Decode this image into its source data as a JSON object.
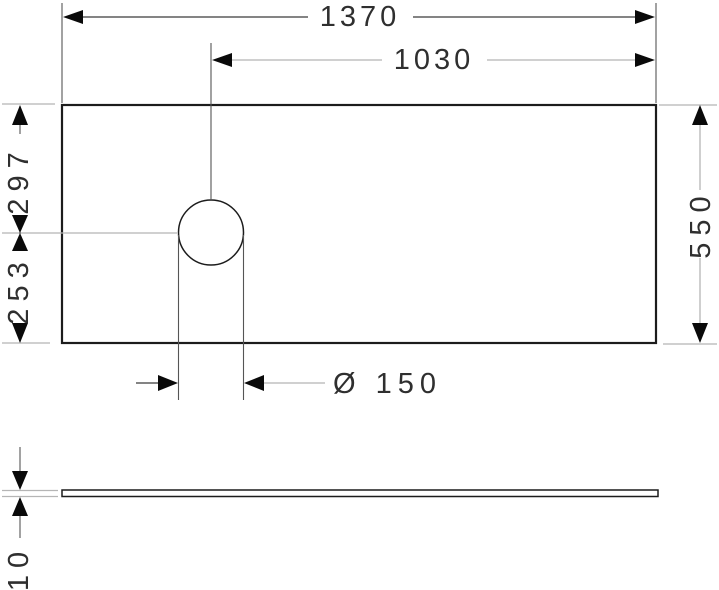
{
  "drawing": {
    "dimensions": {
      "overall_width_mm": "1370",
      "hole_center_from_right_edge_mm": "1030",
      "top_edge_to_hole_center_mm": "297",
      "hole_center_to_bottom_edge_mm": "253",
      "depth_mm": "550",
      "hole_diameter_label": "Ø 150",
      "plate_thickness_mm": "10"
    },
    "colors": {
      "outline": "#1c1c1c",
      "dimension_line": "#3a3a3a",
      "leader_line": "#b5b5b5",
      "arrowhead": "#0a0a0a",
      "text": "#2f2f2f"
    }
  }
}
